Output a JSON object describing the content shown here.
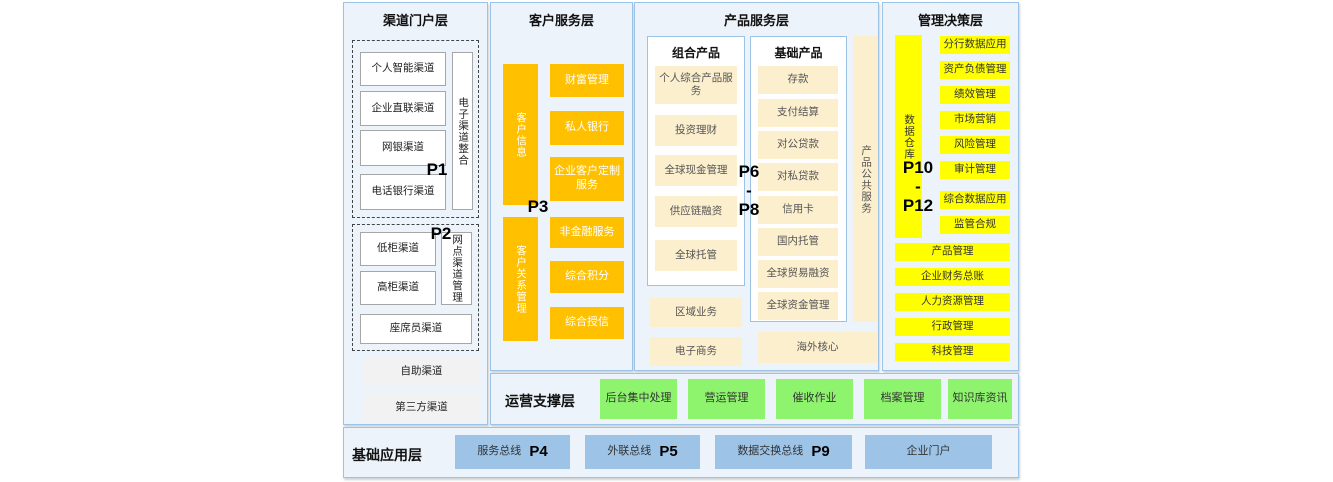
{
  "layers": {
    "channel": {
      "title": "渠道门户层",
      "p1": "P1",
      "p2": "P2",
      "group1": {
        "boxes": [
          "个人智能渠道",
          "企业直联渠道",
          "网银渠道",
          "电话银行渠道"
        ],
        "vertical": "电子渠道整合"
      },
      "group2": {
        "boxes": [
          "低柜渠道",
          "高柜渠道"
        ],
        "vertical": "网点渠道管理",
        "wide": "座席员渠道"
      },
      "extra": [
        "自助渠道",
        "第三方渠道"
      ]
    },
    "customer": {
      "title": "客户服务层",
      "p3": "P3",
      "bar1": "客户信息",
      "boxes1": [
        "财富管理",
        "私人银行",
        "企业客户定制服务"
      ],
      "bar2": "客户关系管理",
      "boxes2": [
        "非金融服务",
        "综合积分",
        "综合授信"
      ]
    },
    "product": {
      "title": "产品服务层",
      "p_range": [
        "P6",
        "-",
        "P8"
      ],
      "combo": {
        "title": "组合产品",
        "boxes": [
          "个人综合产品服务",
          "投资理财",
          "全球现金管理",
          "供应链融资",
          "全球托管"
        ]
      },
      "basic": {
        "title": "基础产品",
        "boxes": [
          "存款",
          "支付结算",
          "对公贷款",
          "对私贷款",
          "信用卡",
          "国内托管",
          "全球贸易融资",
          "全球资金管理"
        ]
      },
      "vertical": "产品公共服务",
      "extra": [
        "区域业务",
        "电子商务"
      ],
      "overseas": "海外核心"
    },
    "management": {
      "title": "管理决策层",
      "p_range": [
        "P10",
        "-",
        "P12"
      ],
      "vertical": "数据仓库",
      "boxes": [
        "分行数据应用",
        "资产负债管理",
        "绩效管理",
        "市场营销",
        "风险管理",
        "审计管理",
        "综合数据应用",
        "监管合规"
      ],
      "wide_boxes": [
        "产品管理",
        "企业财务总账",
        "人力资源管理",
        "行政管理",
        "科技管理"
      ]
    },
    "operation": {
      "title": "运营支撑层",
      "boxes": [
        "后台集中处理",
        "营运管理",
        "催收作业",
        "档案管理",
        "知识库资讯"
      ]
    },
    "foundation": {
      "title": "基础应用层",
      "boxes": [
        {
          "label": "服务总线",
          "p": "P4"
        },
        {
          "label": "外联总线",
          "p": "P5"
        },
        {
          "label": "数据交换总线",
          "p": "P9"
        },
        {
          "label": "企业门户",
          "p": ""
        }
      ]
    }
  },
  "colors": {
    "orange": "#FFC000",
    "yellow": "#FFFF00",
    "green": "#8EF46D",
    "cream": "#FCEFCE",
    "blue": "#9DC3E6",
    "panel_bg": "#EDF3FA",
    "panel_border": "#9CC3E5"
  }
}
